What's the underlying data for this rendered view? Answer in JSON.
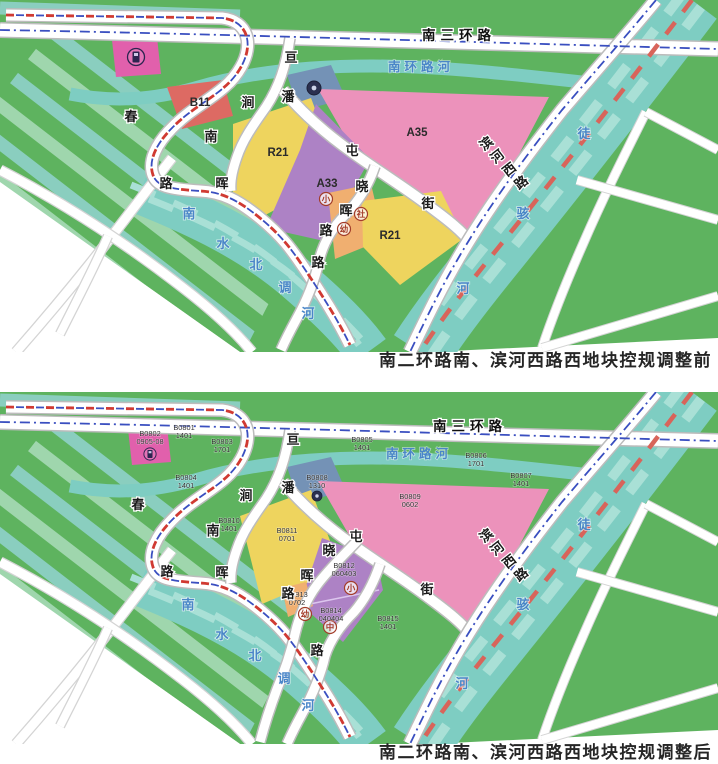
{
  "captions": [
    {
      "id": "before",
      "text": "南二环路南、滨河西路西地块控规调整前"
    },
    {
      "id": "after",
      "text": "南二环路南、滨河西路西地块控规调整后"
    }
  ],
  "colors": {
    "green": "#5eb35f",
    "stripe1": "#9fd6ad",
    "stripe2": "#8acebf",
    "water": "#7ecdc2",
    "waterStripe": "#a9e0d6",
    "road_casing": "#bcbcbc",
    "outside_casing": "#d4d4d4",
    "yellow": "#eed45e",
    "pink": "#ec92bb",
    "red": "#dd6a63",
    "purple": "#ad82c5",
    "orange": "#f0af70",
    "blue": "#7492b6",
    "magenta": "#e160ac",
    "boundary_blue": "#3a4fc0",
    "boundary_red": "#d03a32",
    "river_dash": "#d8645a",
    "divider": "#dcc6ee",
    "white": "#ffffff"
  },
  "geometry": {
    "green_poly": [
      [
        0,
        0
      ],
      [
        718,
        0
      ],
      [
        718,
        338
      ],
      [
        430,
        352
      ],
      [
        240,
        352
      ],
      [
        0,
        182
      ]
    ],
    "white_cut": [
      [
        0,
        182
      ],
      [
        240,
        352
      ],
      [
        0,
        352
      ]
    ],
    "stripe_clip": [
      [
        0,
        0
      ],
      [
        248,
        0
      ],
      [
        248,
        55
      ],
      [
        295,
        252
      ],
      [
        244,
        352
      ],
      [
        0,
        352
      ]
    ],
    "stripes": [
      [
        -40,
        150,
        245,
        370
      ],
      [
        -22,
        126,
        263,
        346
      ],
      [
        -4,
        102,
        281,
        322
      ],
      [
        14,
        78,
        299,
        298
      ],
      [
        32,
        54,
        317,
        274
      ],
      [
        50,
        30,
        335,
        250
      ],
      [
        -58,
        174,
        227,
        394
      ],
      [
        0,
        8,
        240,
        16
      ]
    ],
    "rivers": [
      {
        "id": "tuhai-river-band",
        "d": "M692,0 C645,62 565,165 498,248 C468,285 442,318 420,352",
        "w": 62,
        "stripes": true,
        "red_dash": true
      },
      {
        "id": "nanhuan-river",
        "d": "M70,94 C115,103 155,99 195,88 C245,73 305,66 372,66 C440,66 520,75 600,84",
        "w": 13,
        "stripes": false
      },
      {
        "id": "canal-band",
        "d": "M140,192 C200,216 250,240 295,278 C330,308 352,330 368,352",
        "w": 44,
        "stripes": true
      }
    ],
    "roads": [
      {
        "id": "ring-road",
        "d": "M0,30 C180,33 400,40 718,49",
        "w": 13,
        "boundary": "blue"
      },
      {
        "id": "boundary-road",
        "d": "M6,15 L222,18 C248,21 254,44 241,67 C226,94 196,103 172,128 C156,144 148,161 153,175 C157,186 168,189 200,191 C222,192 238,200 260,218 C282,236 292,250 304,268 C322,295 338,320 350,345",
        "w": 11,
        "boundary": "redblue"
      },
      {
        "id": "pan-road",
        "d": "M290,38 C286,66 279,87 266,107 C254,124 243,139 237,157 C232,171 230,181 231,191",
        "w": 9
      },
      {
        "id": "tun-road",
        "d": "M283,90 C303,114 329,136 353,153 C381,173 407,189 429,206 C448,220 462,231 471,243",
        "w": 10
      },
      {
        "id": "binhe-road",
        "d": "M656,0 C628,34 597,69 562,110 C517,167 484,214 459,257 C439,291 424,323 410,352",
        "w": 12,
        "boundary": "blue"
      }
    ],
    "outside_roads": [
      {
        "d": "M646,112 C622,160 602,200 583,244 C568,278 554,312 542,348",
        "w": 8
      },
      {
        "d": "M646,112 L718,150",
        "w": 8
      },
      {
        "d": "M577,180 L718,220",
        "w": 8
      },
      {
        "d": "M542,348 L718,296",
        "w": 8
      }
    ],
    "white_roads": [
      {
        "d": "M172,158 C135,205 95,262 16,352",
        "w": 9
      },
      {
        "d": "M0,170 C62,202 124,242 182,287 C212,310 236,332 252,352",
        "w": 9
      },
      {
        "d": "M108,236 C92,272 76,302 60,334",
        "w": 8
      }
    ]
  },
  "maps": [
    {
      "id": "before",
      "local_roads": [
        {
          "d": "M375,166 C369,184 359,201 345,215 C331,229 323,244 319,261 C315,280 307,300 296,320 C290,331 285,341 281,350",
          "w": 9
        }
      ],
      "zones": [
        {
          "c": "magenta",
          "name": "gas-station-zone",
          "pts": [
            [
              112,
              40
            ],
            [
              157,
              37
            ],
            [
              161,
              74
            ],
            [
              116,
              77
            ]
          ]
        },
        {
          "c": "red",
          "name": "zone-B11",
          "pts": [
            [
              167,
              87
            ],
            [
              223,
              80
            ],
            [
              233,
              116
            ],
            [
              182,
              129
            ]
          ]
        },
        {
          "c": "blue",
          "name": "facility-zone",
          "pts": [
            [
              287,
              75
            ],
            [
              331,
              65
            ],
            [
              346,
              99
            ],
            [
              299,
              111
            ]
          ]
        },
        {
          "c": "pink",
          "name": "zone-A35",
          "pts": [
            [
              318,
              89
            ],
            [
              549,
              97
            ],
            [
              517,
              158
            ],
            [
              468,
              238
            ],
            [
              431,
              200
            ],
            [
              349,
              143
            ]
          ]
        },
        {
          "c": "yellow",
          "name": "zone-R21-west",
          "pts": [
            [
              233,
              124
            ],
            [
              311,
              98
            ],
            [
              338,
              170
            ],
            [
              297,
              198
            ],
            [
              256,
              220
            ],
            [
              233,
              204
            ]
          ]
        },
        {
          "c": "purple",
          "name": "zone-A33",
          "pts": [
            [
              316,
              104
            ],
            [
              370,
              159
            ],
            [
              324,
              241
            ],
            [
              266,
              228
            ],
            [
              300,
              150
            ]
          ]
        },
        {
          "c": "orange",
          "name": "community-zone",
          "pts": [
            [
              328,
              193
            ],
            [
              371,
              184
            ],
            [
              384,
              239
            ],
            [
              335,
              259
            ]
          ]
        },
        {
          "c": "yellow",
          "name": "zone-R21-east",
          "pts": [
            [
              362,
              201
            ],
            [
              441,
              191
            ],
            [
              464,
              238
            ],
            [
              400,
              285
            ],
            [
              363,
              247
            ]
          ]
        }
      ],
      "divider": null,
      "icons": [
        {
          "k": "gas",
          "x": 136,
          "y": 57
        },
        {
          "k": "dot",
          "x": 314,
          "y": 88
        }
      ],
      "circles": [
        {
          "t": "小",
          "x": 326,
          "y": 199
        },
        {
          "t": "社",
          "x": 361,
          "y": 214
        },
        {
          "t": "幼",
          "x": 344,
          "y": 229
        }
      ],
      "zone_labels": [
        {
          "t": "B11",
          "x": 200,
          "y": 106
        },
        {
          "t": "R21",
          "x": 278,
          "y": 156
        },
        {
          "t": "A33",
          "x": 327,
          "y": 187
        },
        {
          "t": "A35",
          "x": 417,
          "y": 136
        },
        {
          "t": "R21",
          "x": 390,
          "y": 239
        }
      ],
      "parcels": [],
      "road_chars": [
        {
          "t": "亘",
          "x": 291,
          "y": 62
        },
        {
          "t": "潘",
          "x": 288,
          "y": 101
        },
        {
          "t": "涧",
          "x": 248,
          "y": 107
        },
        {
          "t": "南",
          "x": 211,
          "y": 141
        },
        {
          "t": "春",
          "x": 131,
          "y": 121
        },
        {
          "t": "路",
          "x": 166,
          "y": 188
        },
        {
          "t": "晖",
          "x": 222,
          "y": 188
        },
        {
          "t": "屯",
          "x": 352,
          "y": 155
        },
        {
          "t": "晓",
          "x": 362,
          "y": 191
        },
        {
          "t": "街",
          "x": 428,
          "y": 208
        },
        {
          "t": "晖",
          "x": 346,
          "y": 215
        },
        {
          "t": "路",
          "x": 326,
          "y": 235
        },
        {
          "t": "路",
          "x": 318,
          "y": 267
        }
      ],
      "binhe_chars": [
        {
          "t": "滨",
          "x": 489,
          "y": 147
        },
        {
          "t": "河",
          "x": 500,
          "y": 160
        },
        {
          "t": "西",
          "x": 512,
          "y": 173
        },
        {
          "t": "路",
          "x": 524,
          "y": 186
        }
      ],
      "water_chars": [
        {
          "t": "南",
          "x": 189,
          "y": 218
        },
        {
          "t": "水",
          "x": 223,
          "y": 248
        },
        {
          "t": "北",
          "x": 256,
          "y": 269
        },
        {
          "t": "调",
          "x": 285,
          "y": 292
        },
        {
          "t": "河",
          "x": 308,
          "y": 318
        },
        {
          "t": "徒",
          "x": 584,
          "y": 138
        },
        {
          "t": "骇",
          "x": 523,
          "y": 218
        },
        {
          "t": "河",
          "x": 463,
          "y": 293
        }
      ],
      "ring_label": {
        "t": "南三环路",
        "x": 459,
        "y": 40
      },
      "river_label": {
        "t": "南环路河",
        "x": 421,
        "y": 71
      }
    },
    {
      "id": "after",
      "local_roads": [
        {
          "d": "M358,148 C344,163 329,177 317,193 C305,209 299,225 295,242 C291,260 285,278 277,297 C271,313 265,331 260,350",
          "w": 9
        },
        {
          "d": "M380,172 C374,190 366,206 354,220 C340,234 330,248 325,264 C321,282 313,302 302,322 C296,333 291,343 287,352",
          "w": 9
        }
      ],
      "zones": [
        {
          "c": "magenta",
          "name": "zone-B0802",
          "pts": [
            [
              128,
              37
            ],
            [
              167,
              34
            ],
            [
              171,
              70
            ],
            [
              132,
              73
            ]
          ]
        },
        {
          "c": "blue",
          "name": "zone-B0808",
          "pts": [
            [
              287,
              75
            ],
            [
              331,
              65
            ],
            [
              346,
              99
            ],
            [
              299,
              111
            ]
          ]
        },
        {
          "c": "pink",
          "name": "zone-B0809",
          "pts": [
            [
              318,
              89
            ],
            [
              549,
              97
            ],
            [
              517,
              158
            ],
            [
              468,
              238
            ],
            [
              431,
              200
            ],
            [
              349,
              143
            ]
          ]
        },
        {
          "c": "yellow",
          "name": "zone-B0811",
          "pts": [
            [
              240,
              124
            ],
            [
              311,
              98
            ],
            [
              338,
              170
            ],
            [
              300,
              196
            ],
            [
              262,
              212
            ]
          ]
        },
        {
          "c": "purple",
          "name": "zone-B0812-B0814",
          "pts": [
            [
              322,
              146
            ],
            [
              376,
              166
            ],
            [
              383,
              198
            ],
            [
              343,
              250
            ],
            [
              300,
              212
            ]
          ]
        },
        {
          "c": "orange",
          "name": "zone-B0813",
          "pts": [
            [
              282,
              196
            ],
            [
              306,
              190
            ],
            [
              313,
              214
            ],
            [
              288,
              225
            ]
          ]
        }
      ],
      "divider": {
        "x1": 300,
        "y1": 214,
        "x2": 379,
        "y2": 198
      },
      "icons": [
        {
          "k": "gas-small",
          "x": 150,
          "y": 62
        },
        {
          "k": "dot-small",
          "x": 317,
          "y": 104
        }
      ],
      "circles": [
        {
          "t": "小",
          "x": 351,
          "y": 196
        },
        {
          "t": "幼",
          "x": 305,
          "y": 222
        },
        {
          "t": "中",
          "x": 330,
          "y": 235
        }
      ],
      "zone_labels": [],
      "parcels": [
        {
          "l1": "B0801",
          "l2": "1401",
          "x": 184,
          "y": 38
        },
        {
          "l1": "B0802",
          "l2": "0905-08",
          "x": 150,
          "y": 44
        },
        {
          "l1": "B0803",
          "l2": "1701",
          "x": 222,
          "y": 52
        },
        {
          "l1": "B0805",
          "l2": "1401",
          "x": 362,
          "y": 50
        },
        {
          "l1": "B0804",
          "l2": "1401",
          "x": 186,
          "y": 88
        },
        {
          "l1": "B0806",
          "l2": "1701",
          "x": 476,
          "y": 66
        },
        {
          "l1": "B0807",
          "l2": "1401",
          "x": 521,
          "y": 86
        },
        {
          "l1": "B0808",
          "l2": "1310",
          "x": 317,
          "y": 88
        },
        {
          "l1": "B0809",
          "l2": "0602",
          "x": 410,
          "y": 107
        },
        {
          "l1": "B0810",
          "l2": "1401",
          "x": 229,
          "y": 131
        },
        {
          "l1": "B0811",
          "l2": "0701",
          "x": 287,
          "y": 141
        },
        {
          "l1": "B0812",
          "l2": "060403",
          "x": 344,
          "y": 176
        },
        {
          "l1": "B0813",
          "l2": "0702",
          "x": 297,
          "y": 205
        },
        {
          "l1": "B0814",
          "l2": "040404",
          "x": 331,
          "y": 221
        },
        {
          "l1": "B0815",
          "l2": "1401",
          "x": 388,
          "y": 229
        }
      ],
      "road_chars": [
        {
          "t": "亘",
          "x": 293,
          "y": 52
        },
        {
          "t": "潘",
          "x": 288,
          "y": 100
        },
        {
          "t": "涧",
          "x": 246,
          "y": 108
        },
        {
          "t": "南",
          "x": 213,
          "y": 143
        },
        {
          "t": "春",
          "x": 138,
          "y": 117
        },
        {
          "t": "路",
          "x": 167,
          "y": 184
        },
        {
          "t": "晖",
          "x": 222,
          "y": 185
        },
        {
          "t": "屯",
          "x": 356,
          "y": 149
        },
        {
          "t": "晓",
          "x": 329,
          "y": 163
        },
        {
          "t": "晖",
          "x": 307,
          "y": 188
        },
        {
          "t": "路",
          "x": 288,
          "y": 206
        },
        {
          "t": "街",
          "x": 427,
          "y": 202
        },
        {
          "t": "路",
          "x": 317,
          "y": 263
        }
      ],
      "binhe_chars": [
        {
          "t": "滨",
          "x": 489,
          "y": 147
        },
        {
          "t": "河",
          "x": 500,
          "y": 160
        },
        {
          "t": "西",
          "x": 512,
          "y": 173
        },
        {
          "t": "路",
          "x": 524,
          "y": 186
        }
      ],
      "water_chars": [
        {
          "t": "南",
          "x": 188,
          "y": 217
        },
        {
          "t": "水",
          "x": 222,
          "y": 247
        },
        {
          "t": "北",
          "x": 255,
          "y": 268
        },
        {
          "t": "调",
          "x": 284,
          "y": 291
        },
        {
          "t": "河",
          "x": 308,
          "y": 318
        },
        {
          "t": "徒",
          "x": 584,
          "y": 137
        },
        {
          "t": "骇",
          "x": 523,
          "y": 217
        },
        {
          "t": "河",
          "x": 462,
          "y": 296
        }
      ],
      "ring_label": {
        "t": "南三环路",
        "x": 470,
        "y": 39
      },
      "river_label": {
        "t": "南环路河",
        "x": 419,
        "y": 66
      }
    }
  ]
}
